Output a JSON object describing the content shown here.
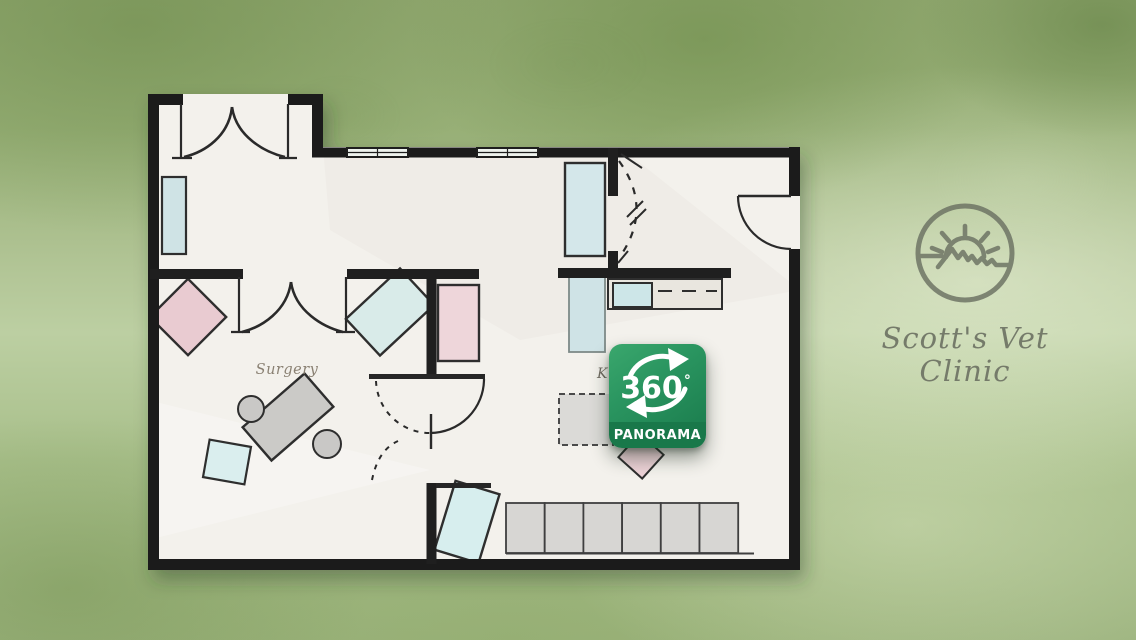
{
  "floor_plan": {
    "labels": {
      "surgery": "Surgery",
      "kennels_partial": "K"
    }
  },
  "badge": {
    "value": "360",
    "degree_symbol": "°",
    "label": "PANORAMA",
    "green": "#2a9560",
    "band_green": "#19784a"
  },
  "logo": {
    "line1": "Scott's Vet",
    "line2": "Clinic",
    "color": "#6f7465"
  },
  "colors": {
    "background_green": "#a8bf8a",
    "paper": "#f3f1ec",
    "wall": "#1b1b1b",
    "furniture_blue": "#d4e7ea",
    "furniture_pink": "#e9cbd1",
    "furniture_gray": "#cbcac7"
  }
}
